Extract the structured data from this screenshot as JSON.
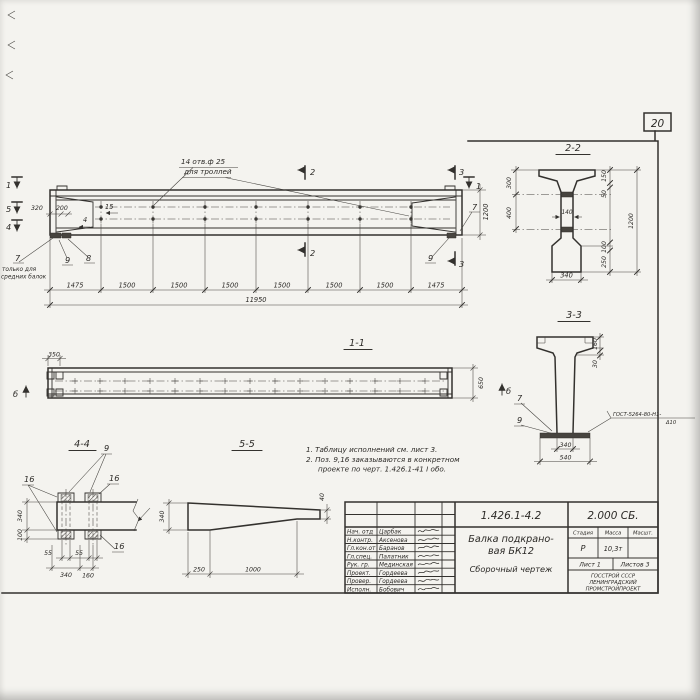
{
  "colors": {
    "paper": "#f4f3ef",
    "ink": "#33312e"
  },
  "sheet": {
    "number": "20"
  },
  "main_view": {
    "hole_note_line1": "14 отв.ф 25",
    "hole_note_line2": "для троллей",
    "m1": "1",
    "m2": "2",
    "m3": "3",
    "m4": "4",
    "m5": "5",
    "p4": "4",
    "p7": "7",
    "p8": "8",
    "p9": "9",
    "p15": "15",
    "only_note_line1": "только для",
    "only_note_line2": "средних балок",
    "dim_320": "320",
    "dim_200": "200",
    "dim_1200": "1200",
    "dims_chain": [
      "1475",
      "1500",
      "1500",
      "1500",
      "1500",
      "1500",
      "1500",
      "1475"
    ],
    "dim_total": "11950"
  },
  "section_2_2": {
    "label": "2-2",
    "dim_300": "300",
    "dim_400": "400",
    "dim_150": "150",
    "dim_50": "50",
    "dim_1200": "1200",
    "dim_100": "100",
    "dim_250": "250",
    "dim_140": "140",
    "dim_340": "340"
  },
  "section_3_3": {
    "label": "3-3",
    "dim_160": "160",
    "dim_30": "30",
    "dim_340": "340",
    "dim_540": "540",
    "pos_7": "7",
    "pos_9": "9",
    "weld_note": "ГОСТ-5264-80-Н1-",
    "weld_note2": "Δ10",
    "marker_b": "б"
  },
  "section_1_1": {
    "label": "1-1",
    "dim_350": "350",
    "dim_650": "650",
    "marker_b": "б"
  },
  "section_4_4": {
    "label": "4-4",
    "pos_9": "9",
    "pos_16": "16",
    "dim_340_v": "340",
    "dim_100": "100",
    "dim_55": "55",
    "dim_340_h": "340",
    "dim_160": "160"
  },
  "section_5_5": {
    "label": "5-5",
    "dim_340": "340",
    "dim_40": "40",
    "dim_250": "250",
    "dim_1000": "1000"
  },
  "notes": {
    "line1": "1. Таблицу исполнений см. лист 3.",
    "line2": "2. Поз. 9,16 заказываются в конкретном",
    "line3": "проекте по черт. 1.426.1-41 I обо."
  },
  "title_block": {
    "doc_number": "1.426.1-4.2",
    "doc_code": "2.000 СБ.",
    "title_line1": "Балка подкрано-",
    "title_line2": "вая БК12",
    "title_line3": "Сборочный чертеж",
    "stage_header": "Стадия",
    "mass_header": "Масса",
    "scale_header": "Масшт.",
    "stage": "Р",
    "mass": "10,3т",
    "sheet_label": "Лист 1",
    "sheets_label": "Листов 3",
    "org_line1": "ГОССТРОЙ СССР",
    "org_line2": "ЛЕНИНГРАДСКИЙ",
    "org_line3": "ПРОМСТРОЙПРОЕКТ",
    "signers": [
      {
        "role": "Нач. отд",
        "name": "Царбак"
      },
      {
        "role": "Н.контр.",
        "name": "Аксенова"
      },
      {
        "role": "Гл.кон.от",
        "name": "Баранов"
      },
      {
        "role": "Гл.спец.",
        "name": "Палатник"
      },
      {
        "role": "Рук. гр.",
        "name": "Мединская"
      },
      {
        "role": "Проект.",
        "name": "Гордеева"
      },
      {
        "role": "Провер.",
        "name": "Гордеева"
      },
      {
        "role": "Исполн.",
        "name": "Бобович"
      }
    ]
  }
}
